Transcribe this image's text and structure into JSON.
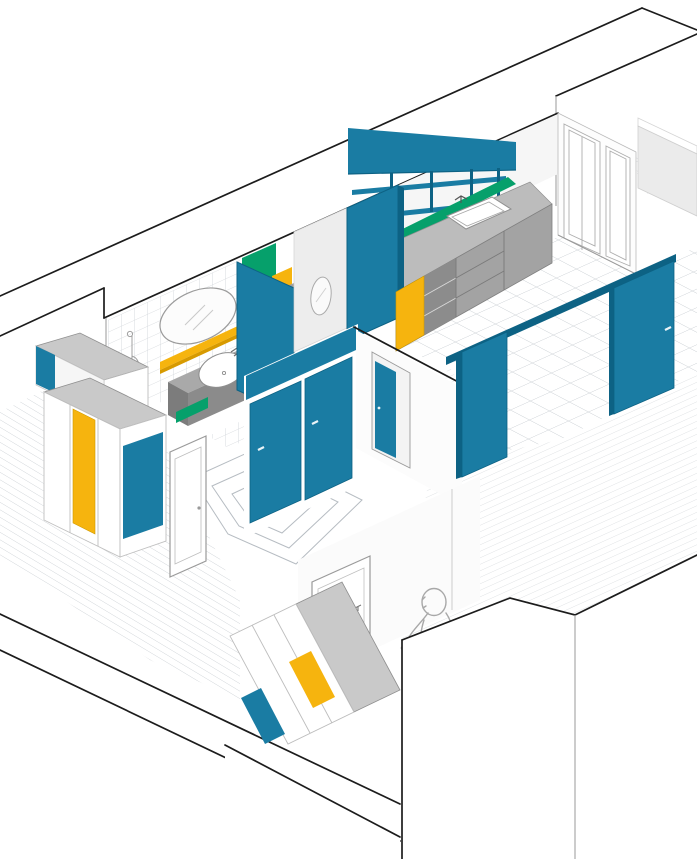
{
  "palette": {
    "teal": "#1a7ca3",
    "tealDark": "#0d6284",
    "yellow": "#f6b40e",
    "yellowDark": "#d79a00",
    "green": "#06a06b",
    "counterGray": "#bcbcbc",
    "cabinetGray": "#a3a3a3",
    "darkGray": "#8b8b8b",
    "topGray": "#c9c9c9",
    "wallLight": "#ededed",
    "wallFace": "#f4f4f4",
    "lineBlack": "#1c1c1c",
    "lineGray": "#9a9a9a",
    "tileLine": "#c8cdd2",
    "plankLine": "#bdc3c8",
    "figureLine": "#a8a8a8",
    "white": "#ffffff"
  },
  "scene": {
    "type": "axonometric-apartment-cutaway",
    "rooms": [
      {
        "name": "bathroom",
        "floor": "tile",
        "elements": [
          "tiled-wall",
          "oval-mirror",
          "yellow-shelf",
          "shower-fixture",
          "vanity-counter",
          "vessel-sink",
          "green-toe-kick",
          "teal-sliding-door"
        ]
      },
      {
        "name": "wc",
        "floor": "tile",
        "elements": [
          "green-cabinet",
          "yellow-drawer",
          "gray-side-wall",
          "oval-mirror-small"
        ]
      },
      {
        "name": "kitchen",
        "floor": "tile",
        "elements": [
          "teal-tall-unit",
          "teal-upper-shelf-slab",
          "open-teal-shelves",
          "green-backsplash",
          "gray-countertop",
          "inset-sink",
          "faucet",
          "base-cabinets",
          "yellow-end-panel",
          "french-window-wall"
        ]
      },
      {
        "name": "balcony",
        "floor": "tile-small",
        "elements": [
          "parapet-wall"
        ]
      },
      {
        "name": "hallway",
        "floor": "nested-parquet",
        "elements": [
          "teal-closet-door-left",
          "teal-closet-door-right",
          "teal-header-band",
          "doorway-with-teal-door"
        ]
      },
      {
        "name": "living-dining",
        "floor": "wood-planks",
        "elements": [
          "sliding-rail",
          "teal-sliding-panel-left",
          "teal-sliding-panel-right"
        ]
      },
      {
        "name": "bedroom-1",
        "floor": "wood-planks",
        "elements": [
          "wardrobe-upper-tier",
          "wardrobe-lower-tier",
          "yellow-wardrobe-door",
          "teal-wardrobe-panel",
          "white-door"
        ]
      },
      {
        "name": "bedroom-2",
        "floor": "plain",
        "elements": [
          "wardrobe",
          "yellow-panel",
          "teal-panel",
          "white-door",
          "walking-person-sketch"
        ]
      }
    ]
  }
}
